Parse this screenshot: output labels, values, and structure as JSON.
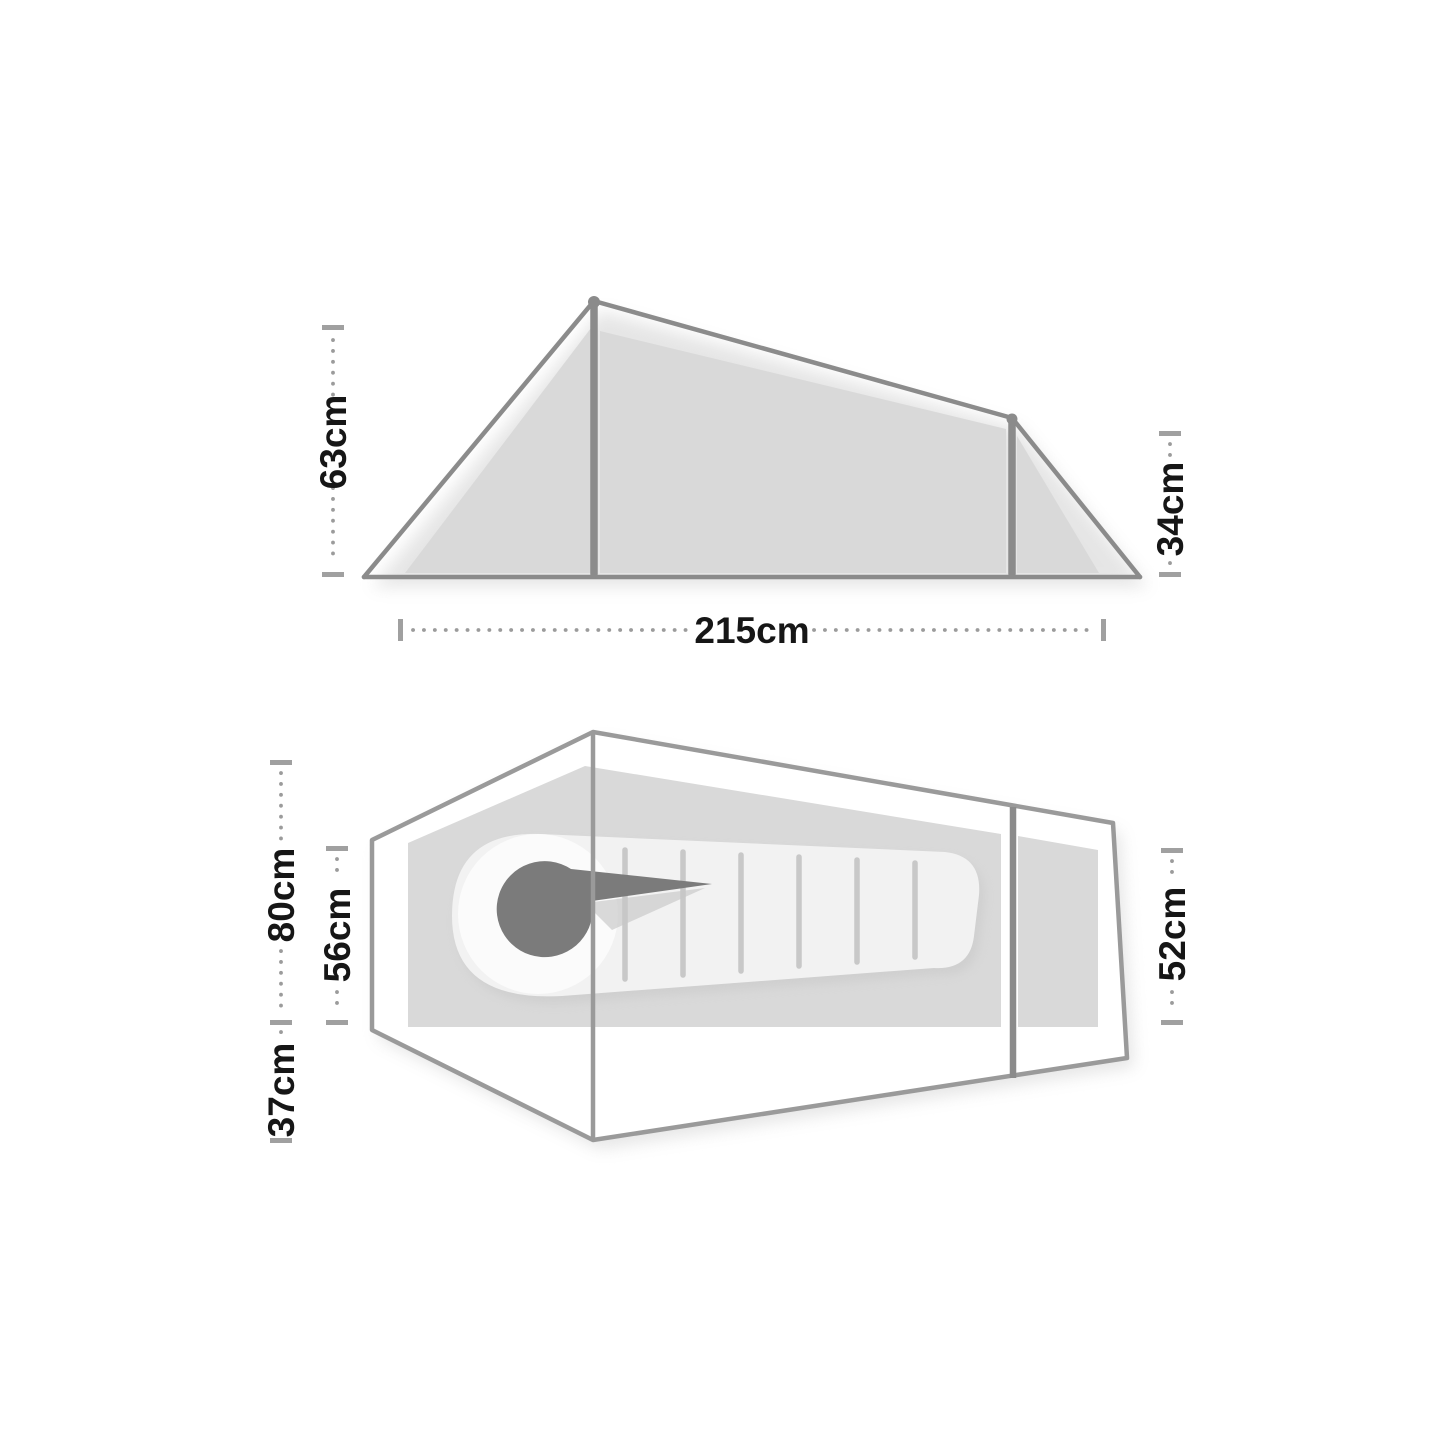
{
  "diagram": {
    "subject": "tent-dimensions-technical-drawing",
    "side_view": {
      "height_front": "63cm",
      "height_rear": "34cm",
      "length": "215cm"
    },
    "top_view": {
      "width_head_outer": "80cm",
      "width_head_inner": "56cm",
      "porch_depth": "37cm",
      "width_rear": "52cm"
    },
    "colors": {
      "background": "#ffffff",
      "frame_line": "#8b8b8b",
      "fabric_fill": "#d9d9d9",
      "dimension_marks": "#9b9b9b",
      "label_text": "#161616",
      "sleeping_bag_body": "#f2f2f2",
      "sleeping_bag_hood": "#7b7b7b"
    }
  }
}
